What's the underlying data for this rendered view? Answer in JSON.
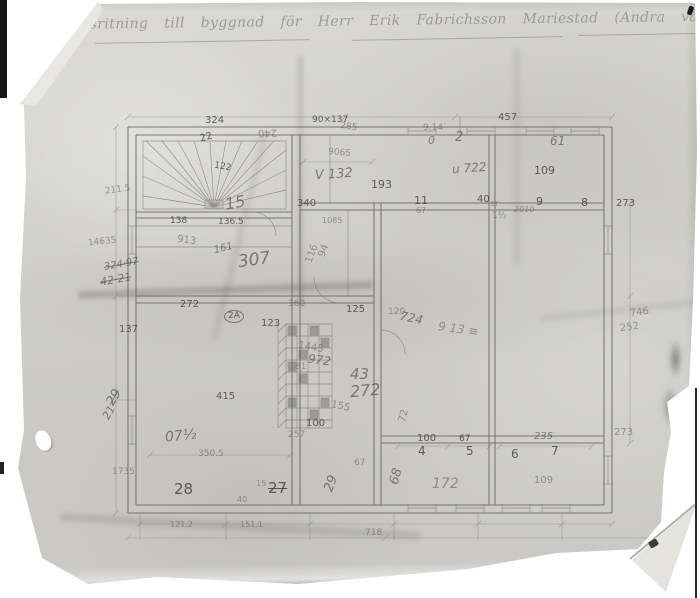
{
  "document": {
    "title_line": "Arbetsritning till byggnad för Herr Erik Fabrichsson  Mariestad  (Andra våning"
  },
  "colors": {
    "paper_color": "#d6d5d1",
    "pencil_color": "#605f59",
    "edge_ink": "#1a1a1a"
  },
  "annotations": [
    {
      "t": "324",
      "x": 205,
      "y": 116
    },
    {
      "t": "22",
      "x": 200,
      "y": 133,
      "r": -15
    },
    {
      "t": "240",
      "x": 258,
      "y": 127,
      "r": 178,
      "c": "faint"
    },
    {
      "t": "90×137",
      "x": 312,
      "y": 116,
      "s": 9
    },
    {
      "t": "285",
      "x": 340,
      "y": 123,
      "r": 8,
      "s": 9,
      "c": "faint"
    },
    {
      "t": "9.14",
      "x": 423,
      "y": 124,
      "s": 9,
      "c": "faint"
    },
    {
      "t": "0",
      "x": 428,
      "y": 135,
      "s": 11,
      "c": "scrawl"
    },
    {
      "t": "2",
      "x": 455,
      "y": 131,
      "s": 13,
      "c": "scrawl"
    },
    {
      "t": "457",
      "x": 498,
      "y": 113
    },
    {
      "t": "61",
      "x": 550,
      "y": 135,
      "s": 12,
      "c": "scrawl"
    },
    {
      "t": "9065",
      "x": 328,
      "y": 149,
      "r": 5,
      "s": 9,
      "c": "faint"
    },
    {
      "t": "V 132",
      "x": 315,
      "y": 168,
      "s": 13,
      "r": -4,
      "c": "scrawl"
    },
    {
      "t": "193",
      "x": 371,
      "y": 179,
      "s": 11
    },
    {
      "t": "u 722",
      "x": 452,
      "y": 162,
      "s": 12,
      "r": -4,
      "c": "scrawl"
    },
    {
      "t": "109",
      "x": 534,
      "y": 165,
      "s": 11
    },
    {
      "t": "122",
      "x": 214,
      "y": 163,
      "r": 10,
      "s": 9
    },
    {
      "t": "15",
      "x": 225,
      "y": 195,
      "s": 16,
      "r": -10,
      "c": "scrawl"
    },
    {
      "t": "1085",
      "x": 322,
      "y": 217,
      "s": 8,
      "c": "faint"
    },
    {
      "t": "211.5",
      "x": 105,
      "y": 186,
      "r": -8,
      "s": 9,
      "c": "faint"
    },
    {
      "t": "14635",
      "x": 88,
      "y": 238,
      "r": -6,
      "s": 9,
      "c": "faint"
    },
    {
      "t": "324·97",
      "x": 104,
      "y": 260,
      "r": -10,
      "s": 10,
      "c": "scrawl strike"
    },
    {
      "t": "42·21",
      "x": 100,
      "y": 274,
      "r": -10,
      "s": 11,
      "c": "scrawl strike"
    },
    {
      "t": "138",
      "x": 170,
      "y": 217,
      "s": 9
    },
    {
      "t": "136.5",
      "x": 218,
      "y": 218,
      "s": 9
    },
    {
      "t": "913",
      "x": 177,
      "y": 236,
      "r": 8,
      "s": 10,
      "c": "faint"
    },
    {
      "t": "161",
      "x": 214,
      "y": 244,
      "r": -14,
      "s": 10,
      "c": "scrawl"
    },
    {
      "t": "307",
      "x": 238,
      "y": 252,
      "s": 17,
      "r": -8,
      "c": "scrawl"
    },
    {
      "t": "116",
      "x": 303,
      "y": 249,
      "r": -70,
      "s": 10,
      "c": "faint"
    },
    {
      "t": "94",
      "x": 318,
      "y": 246,
      "r": -70,
      "s": 10,
      "c": "faint"
    },
    {
      "t": "340",
      "x": 297,
      "y": 199,
      "s": 10
    },
    {
      "t": "11",
      "x": 414,
      "y": 195,
      "s": 11
    },
    {
      "t": "40",
      "x": 477,
      "y": 195,
      "s": 10
    },
    {
      "t": "ET",
      "x": 491,
      "y": 202,
      "s": 6,
      "c": "faint"
    },
    {
      "t": "9",
      "x": 536,
      "y": 196,
      "s": 11
    },
    {
      "t": "8",
      "x": 581,
      "y": 197,
      "s": 11
    },
    {
      "t": "273",
      "x": 616,
      "y": 199,
      "s": 10
    },
    {
      "t": "67",
      "x": 416,
      "y": 207,
      "s": 8,
      "c": "faint"
    },
    {
      "t": "1½",
      "x": 492,
      "y": 212,
      "s": 9,
      "c": "faint"
    },
    {
      "t": "2010",
      "x": 514,
      "y": 206,
      "s": 8,
      "c": "scrawl faint"
    },
    {
      "t": "272",
      "x": 180,
      "y": 300,
      "s": 10
    },
    {
      "t": "360",
      "x": 288,
      "y": 300,
      "s": 9,
      "c": "faint"
    },
    {
      "t": "2A",
      "x": 224,
      "y": 310,
      "s": 9,
      "c": "circled"
    },
    {
      "t": "123",
      "x": 261,
      "y": 319,
      "s": 10
    },
    {
      "t": "137",
      "x": 119,
      "y": 325,
      "s": 10
    },
    {
      "t": "125",
      "x": 346,
      "y": 305,
      "s": 10
    },
    {
      "t": "120",
      "x": 388,
      "y": 308,
      "s": 9,
      "c": "faint"
    },
    {
      "t": "724",
      "x": 400,
      "y": 312,
      "r": 12,
      "s": 12,
      "c": "scrawl"
    },
    {
      "t": "9 13 ≡",
      "x": 438,
      "y": 323,
      "r": 8,
      "s": 12,
      "c": "scrawl faint"
    },
    {
      "t": "746",
      "x": 630,
      "y": 308,
      "r": -8,
      "s": 10,
      "c": "faint"
    },
    {
      "t": "252",
      "x": 620,
      "y": 323,
      "r": -8,
      "s": 10,
      "c": "faint"
    },
    {
      "t": "1445",
      "x": 298,
      "y": 343,
      "r": 10,
      "s": 10,
      "c": "faint"
    },
    {
      "t": "972",
      "x": 308,
      "y": 354,
      "r": 8,
      "s": 12,
      "c": "scrawl"
    },
    {
      "t": "81",
      "x": 295,
      "y": 363,
      "s": 9,
      "c": "faint"
    },
    {
      "t": "43",
      "x": 350,
      "y": 367,
      "s": 15,
      "c": "scrawl"
    },
    {
      "t": "272",
      "x": 350,
      "y": 383,
      "s": 16,
      "r": -5,
      "c": "scrawl"
    },
    {
      "t": "155",
      "x": 331,
      "y": 402,
      "r": 12,
      "s": 10,
      "c": "faint"
    },
    {
      "t": "100",
      "x": 306,
      "y": 419,
      "s": 10
    },
    {
      "t": "72",
      "x": 398,
      "y": 411,
      "r": -75,
      "s": 10,
      "c": "faint"
    },
    {
      "t": "257",
      "x": 288,
      "y": 431,
      "s": 9,
      "c": "faint"
    },
    {
      "t": "67",
      "x": 354,
      "y": 459,
      "s": 9,
      "c": "faint"
    },
    {
      "t": "68",
      "x": 388,
      "y": 470,
      "r": -75,
      "s": 13,
      "c": "scrawl"
    },
    {
      "t": "29",
      "x": 323,
      "y": 477,
      "r": -70,
      "s": 13,
      "c": "scrawl"
    },
    {
      "t": "29",
      "x": 106,
      "y": 391,
      "r": -60,
      "s": 13,
      "c": "scrawl strike"
    },
    {
      "t": "21",
      "x": 102,
      "y": 407,
      "r": -60,
      "s": 11,
      "c": "scrawl"
    },
    {
      "t": "415",
      "x": 216,
      "y": 392,
      "s": 10
    },
    {
      "t": "07½",
      "x": 165,
      "y": 429,
      "s": 14,
      "r": -6,
      "c": "scrawl"
    },
    {
      "t": "350.5",
      "x": 198,
      "y": 450,
      "s": 9,
      "c": "faint"
    },
    {
      "t": "1735",
      "x": 112,
      "y": 468,
      "s": 9,
      "c": "faint"
    },
    {
      "t": "28",
      "x": 174,
      "y": 482,
      "s": 15
    },
    {
      "t": "15",
      "x": 256,
      "y": 480,
      "s": 8,
      "c": "faint"
    },
    {
      "t": "27",
      "x": 268,
      "y": 481,
      "s": 15,
      "c": "strike"
    },
    {
      "t": "40",
      "x": 237,
      "y": 496,
      "s": 8,
      "c": "faint"
    },
    {
      "t": "100",
      "x": 417,
      "y": 434,
      "s": 10
    },
    {
      "t": "67",
      "x": 459,
      "y": 435,
      "s": 9
    },
    {
      "t": "235",
      "x": 534,
      "y": 432,
      "s": 10,
      "c": "scrawl"
    },
    {
      "t": "4",
      "x": 418,
      "y": 445,
      "s": 12
    },
    {
      "t": "5",
      "x": 466,
      "y": 445,
      "s": 12
    },
    {
      "t": "6",
      "x": 511,
      "y": 448,
      "s": 12
    },
    {
      "t": "7",
      "x": 551,
      "y": 445,
      "s": 12
    },
    {
      "t": "273",
      "x": 614,
      "y": 428,
      "s": 10,
      "c": "faint"
    },
    {
      "t": "172",
      "x": 432,
      "y": 477,
      "s": 14,
      "c": "scrawl faint"
    },
    {
      "t": "109",
      "x": 534,
      "y": 476,
      "s": 10,
      "c": "faint"
    },
    {
      "t": "121.2",
      "x": 170,
      "y": 521,
      "s": 8,
      "c": "faint"
    },
    {
      "t": "151.1",
      "x": 240,
      "y": 521,
      "s": 8,
      "c": "faint"
    },
    {
      "t": "718",
      "x": 365,
      "y": 529,
      "s": 9,
      "c": "faint"
    }
  ]
}
